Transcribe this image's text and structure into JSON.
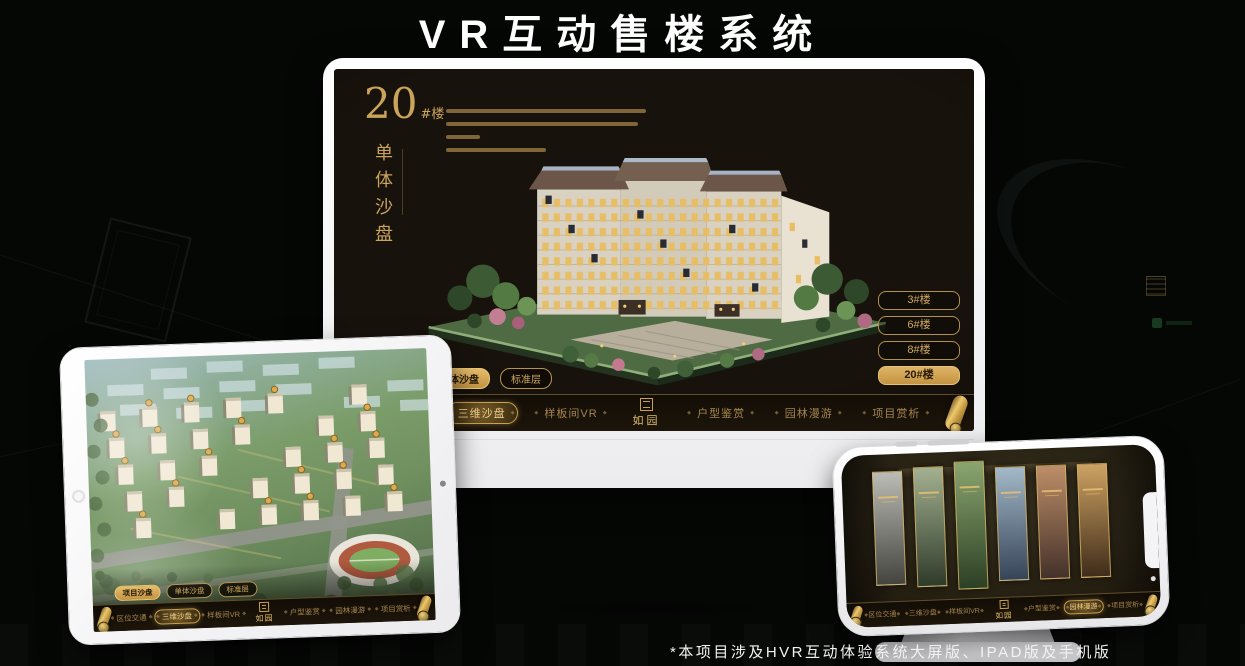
{
  "page": {
    "title": "VR互动售楼系统",
    "footnote": "*本项目涉及HVR互动体验系统大屏版、IPAD版及手机版"
  },
  "colors": {
    "accent_gold": "#c9a45a",
    "active_gold_fill": "#d8ab5c",
    "screen_background": "#18120c",
    "page_background": "#050705",
    "title_white": "#ffffff"
  },
  "icons": {
    "scroll_handle": "gold-scroll-handle",
    "logo_seal": "seal-grid-square",
    "nav_ornament": "◆"
  },
  "desktop": {
    "block_number": "20",
    "block_number_suffix": "#楼",
    "block_subtitle_vertical": "单体沙盘",
    "logo": "如园",
    "floor_buttons": [
      {
        "label": "3#楼",
        "active": false
      },
      {
        "label": "6#楼",
        "active": false
      },
      {
        "label": "8#楼",
        "active": false
      },
      {
        "label": "20#楼",
        "active": true
      }
    ],
    "view_tabs": [
      {
        "label": "项目沙盘",
        "active": false
      },
      {
        "label": "单体沙盘",
        "active": true
      },
      {
        "label": "标准层",
        "active": false
      }
    ],
    "nav_left": [
      {
        "label": "区位交通",
        "active": false
      },
      {
        "label": "三维沙盘",
        "active": true
      },
      {
        "label": "样板间VR",
        "active": false
      }
    ],
    "nav_right": [
      {
        "label": "户型鉴赏",
        "active": false
      },
      {
        "label": "园林漫游",
        "active": false
      },
      {
        "label": "项目赏析",
        "active": false
      }
    ]
  },
  "tablet": {
    "logo": "如园",
    "view_tabs": [
      {
        "label": "项目沙盘",
        "active": true
      },
      {
        "label": "单体沙盘",
        "active": false
      },
      {
        "label": "标准层",
        "active": false
      }
    ],
    "nav_left": [
      {
        "label": "区位交通",
        "active": false
      },
      {
        "label": "三维沙盘",
        "active": true
      },
      {
        "label": "样板间VR",
        "active": false
      }
    ],
    "nav_right": [
      {
        "label": "户型鉴赏",
        "active": false
      },
      {
        "label": "园林漫游",
        "active": false
      },
      {
        "label": "项目赏析",
        "active": false
      }
    ]
  },
  "phone": {
    "logo": "如园",
    "nav_left": [
      {
        "label": "区位交通",
        "active": false
      },
      {
        "label": "三维沙盘",
        "active": false
      },
      {
        "label": "样板间VR",
        "active": false
      }
    ],
    "nav_right": [
      {
        "label": "户型鉴赏",
        "active": false
      },
      {
        "label": "园林漫游",
        "active": true
      },
      {
        "label": "项目赏析",
        "active": false
      }
    ],
    "gallery_panels": [
      {
        "name": "gate-gray",
        "top": "#bcbcb6",
        "bottom": "#44443e"
      },
      {
        "name": "courtyard-green",
        "top": "#a3b191",
        "bottom": "#2f3b29"
      },
      {
        "name": "garden-path",
        "top": "#8aa56f",
        "bottom": "#2c3f24"
      },
      {
        "name": "building-blue",
        "top": "#a3b8c8",
        "bottom": "#364457"
      },
      {
        "name": "autumn-court",
        "top": "#bd8e68",
        "bottom": "#44312a"
      },
      {
        "name": "interior-warm",
        "top": "#cda263",
        "bottom": "#3f2c1a"
      }
    ]
  }
}
